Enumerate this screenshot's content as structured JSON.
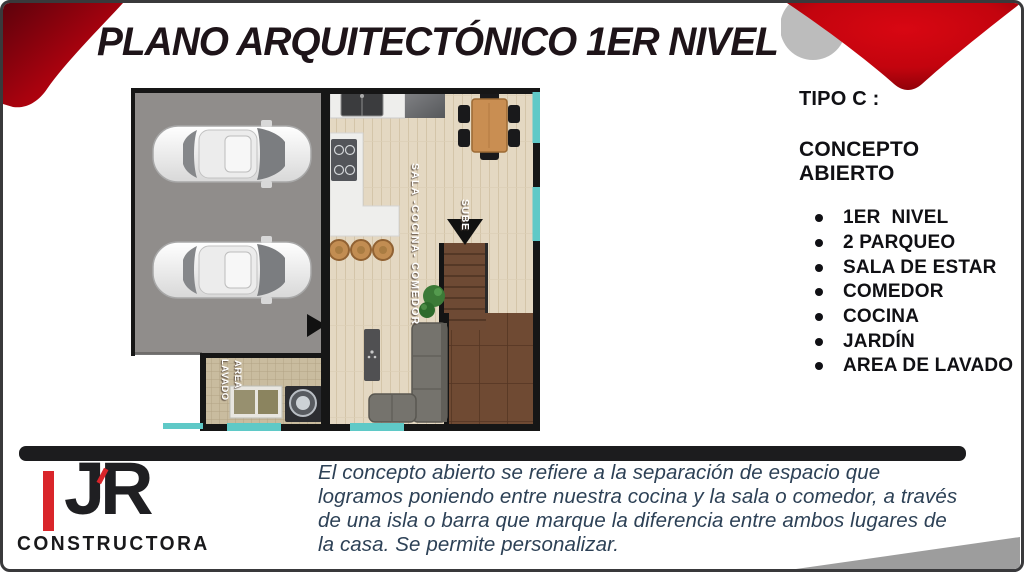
{
  "slide": {
    "title": "PLANO ARQUITECTÓNICO 1ER NIVEL"
  },
  "panel": {
    "type_label": "TIPO C :",
    "subtitle": "CONCEPTO ABIERTO",
    "items": [
      {
        "label": "1ER  NIVEL"
      },
      {
        "label": "2 PARQUEO"
      },
      {
        "label": "SALA DE ESTAR"
      },
      {
        "label": "COMEDOR"
      },
      {
        "label": "COCINA"
      },
      {
        "label": "JARDÍN"
      },
      {
        "label": "AREA DE LAVADO"
      }
    ]
  },
  "floor_plan": {
    "room_label": "SALA -COCINA- COMEDOR",
    "stairs_label": "SUBE",
    "laundry_label_line1": "AREA",
    "laundry_label_line2": "LAVADO"
  },
  "footer": {
    "description": "El concepto abierto se refiere a la separación de espacio que logramos poniendo entre nuestra cocina y la sala o comedor, a través de una isla o barra que marque la diferencia entre ambos lugares de la casa. Se permite personalizar.",
    "logo_text": "JR",
    "logo_subtext": "CONSTRUCTORA"
  },
  "colors": {
    "brand_red": "#c40410",
    "teal_accent": "#5fc9c7",
    "title_dark": "#1e1419",
    "paragraph_blue": "#2d4156",
    "bar_black": "#1c1c1e",
    "garage_gray": "#908d8b"
  }
}
